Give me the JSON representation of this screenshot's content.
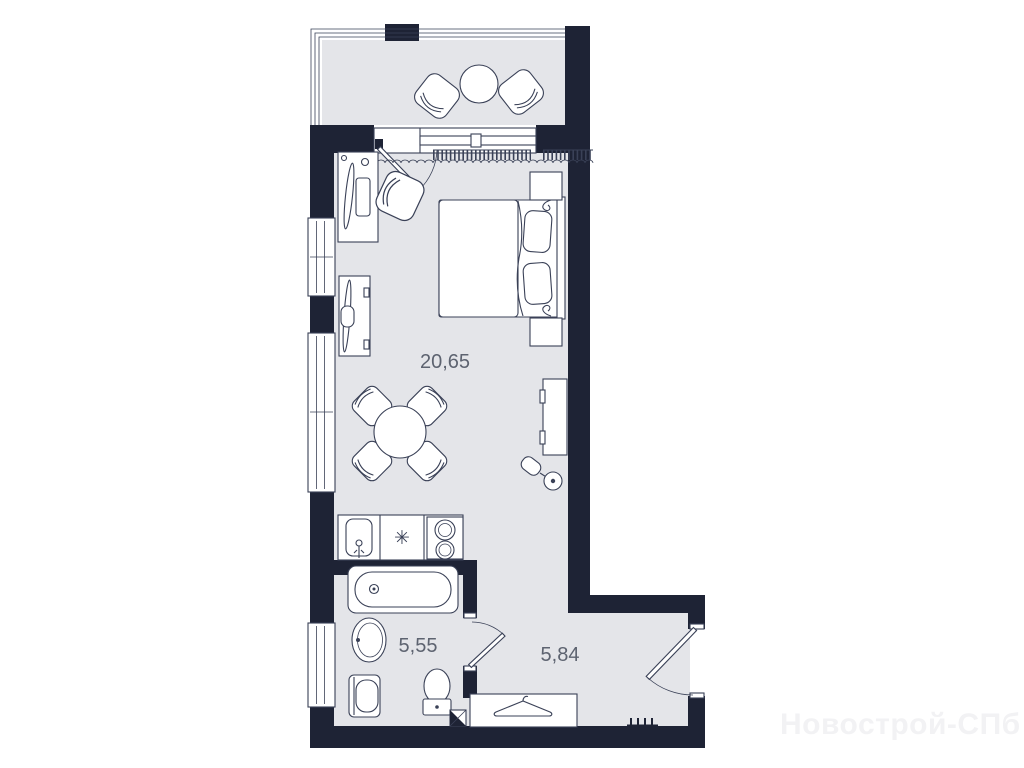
{
  "watermark": {
    "text": "Новострой-СПб"
  },
  "theme": {
    "wall": "#1e2335",
    "floor": "#e4e5e9",
    "line": "#3a4157",
    "label": "#5d6370",
    "furn": "#ffffff",
    "watermark": "#f2f2f4",
    "bg": "#ffffff"
  },
  "plan": {
    "type": "studio-apartment-floor-plan",
    "rooms": [
      {
        "id": "living-room",
        "area_label": "20,65"
      },
      {
        "id": "bathroom",
        "area_label": "5,55"
      },
      {
        "id": "hallway",
        "area_label": "5,84"
      }
    ],
    "symbols": {
      "hob_marker": "✳"
    },
    "furniture": [
      "balcony-chair",
      "balcony-chair",
      "balcony-round-table",
      "desk",
      "desk-chair",
      "double-bed",
      "pillow",
      "pillow",
      "nightstand",
      "nightstand",
      "dresser",
      "dining-table",
      "dining-chair",
      "dining-chair",
      "dining-chair",
      "dining-chair",
      "tv-stand",
      "floor-lamp",
      "kitchen-counter",
      "kitchen-sink",
      "hob",
      "bathtub",
      "washbasin",
      "washing-machine",
      "toilet",
      "ventilation-shaft",
      "wardrobe",
      "clothes-hanger-icon",
      "radiator",
      "curtain",
      "balcony-door",
      "bathroom-door",
      "entrance-door",
      "window",
      "window",
      "window"
    ]
  }
}
